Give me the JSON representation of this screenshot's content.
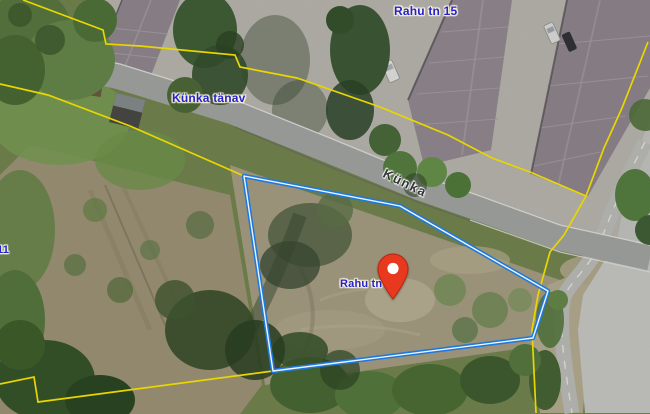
{
  "map": {
    "labels": {
      "rahu_tn_15": "Rahu tn 15",
      "kunka_tanav": "Künka tänav",
      "kunka_street": "Künka",
      "rahu_tn_11": "Rahu tn 11",
      "left_edge_partial": "11"
    },
    "colors": {
      "address_label_text": "#2323cd",
      "street_label_text": "#35353b",
      "cadastral_boundary": "#e9d600",
      "selected_parcel_outline": "#2079d8",
      "location_pin": "#e8391f"
    }
  }
}
